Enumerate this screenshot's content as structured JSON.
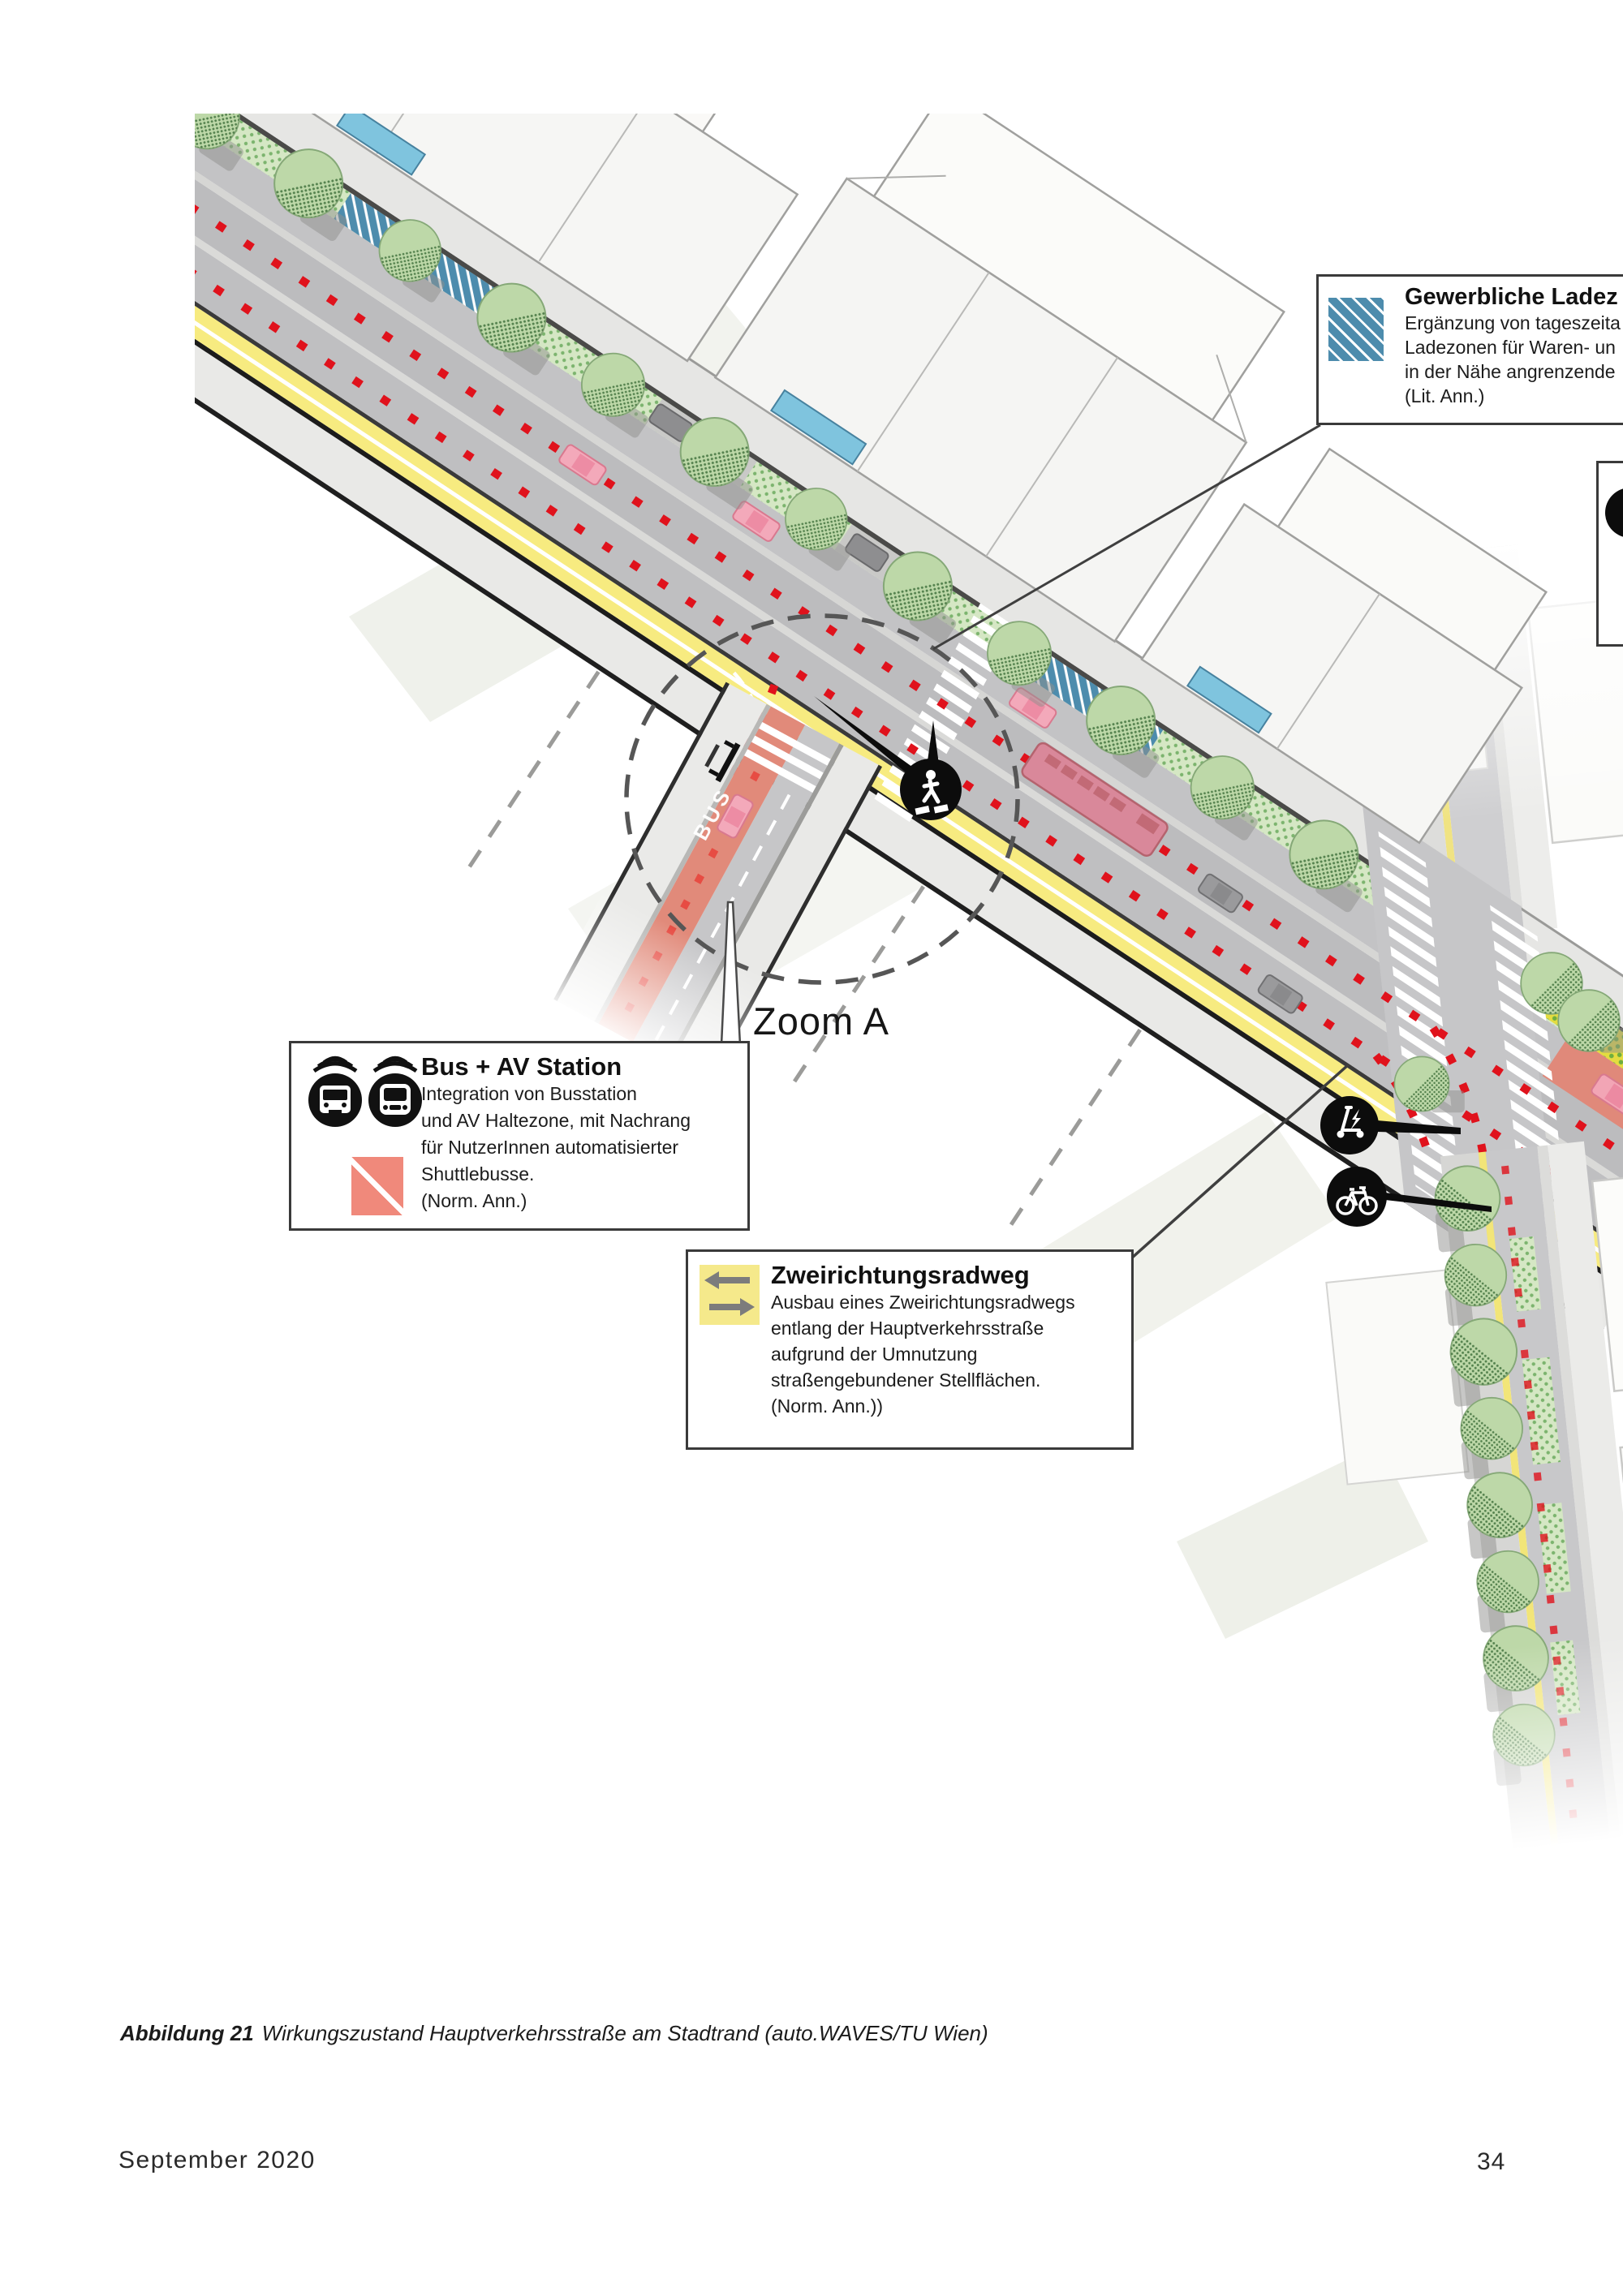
{
  "page": {
    "caption": {
      "label": "Abbildung 21",
      "text": "Wirkungszustand Hauptverkehrsstraße am Stadtrand (auto.WAVES/TU Wien)"
    },
    "footer": {
      "date": "September 2020",
      "page_number": "34"
    }
  },
  "figure": {
    "zoom_label": "Zoom A",
    "road_marking_bus": "BUS",
    "callouts": {
      "loading_zone": {
        "title": "Gewerbliche Ladez",
        "lines": [
          "Ergänzung von tageszeita",
          "Ladezonen für Waren- un",
          "in der Nähe angrenzende",
          "(Lit. Ann.)"
        ],
        "icon": "blue-hatch-square-icon",
        "icon_color": "#4d8cad"
      },
      "bus_av_station": {
        "title": "Bus + AV Station",
        "lines": [
          "Integration von Busstation",
          "und AV Haltezone, mit Nachrang",
          "für NutzerInnen automatisierter",
          "Shuttlebusse.",
          "(Norm. Ann.)"
        ],
        "icons": [
          "bus-icon",
          "av-shuttle-icon",
          "salmon-diagonal-square-icon"
        ],
        "icon_color": "#f0897b"
      },
      "bike_path": {
        "title": "Zweirichtungsradweg",
        "lines": [
          "Ausbau eines Zweirichtungsradwegs",
          "entlang der Hauptverkehrsstraße",
          "aufgrund der Umnutzung",
          "straßengebundener Stellflächen.",
          "(Norm. Ann.))"
        ],
        "icon": "two-way-arrows-yellow-square-icon",
        "icon_color": "#f4e88a"
      }
    },
    "map_icons": [
      "pedestrian-crossing-icon",
      "e-scooter-charging-icon",
      "bike-icon"
    ],
    "colors": {
      "av_route_dots": "#e0121c",
      "bike_path_yellow": "#f7eb80",
      "bus_lane_salmon": "#e08a7c",
      "loading_zone_blue": "#4d8cad",
      "tree_green": "#bdd8a8",
      "road_gray": "#bfbfc1"
    }
  }
}
